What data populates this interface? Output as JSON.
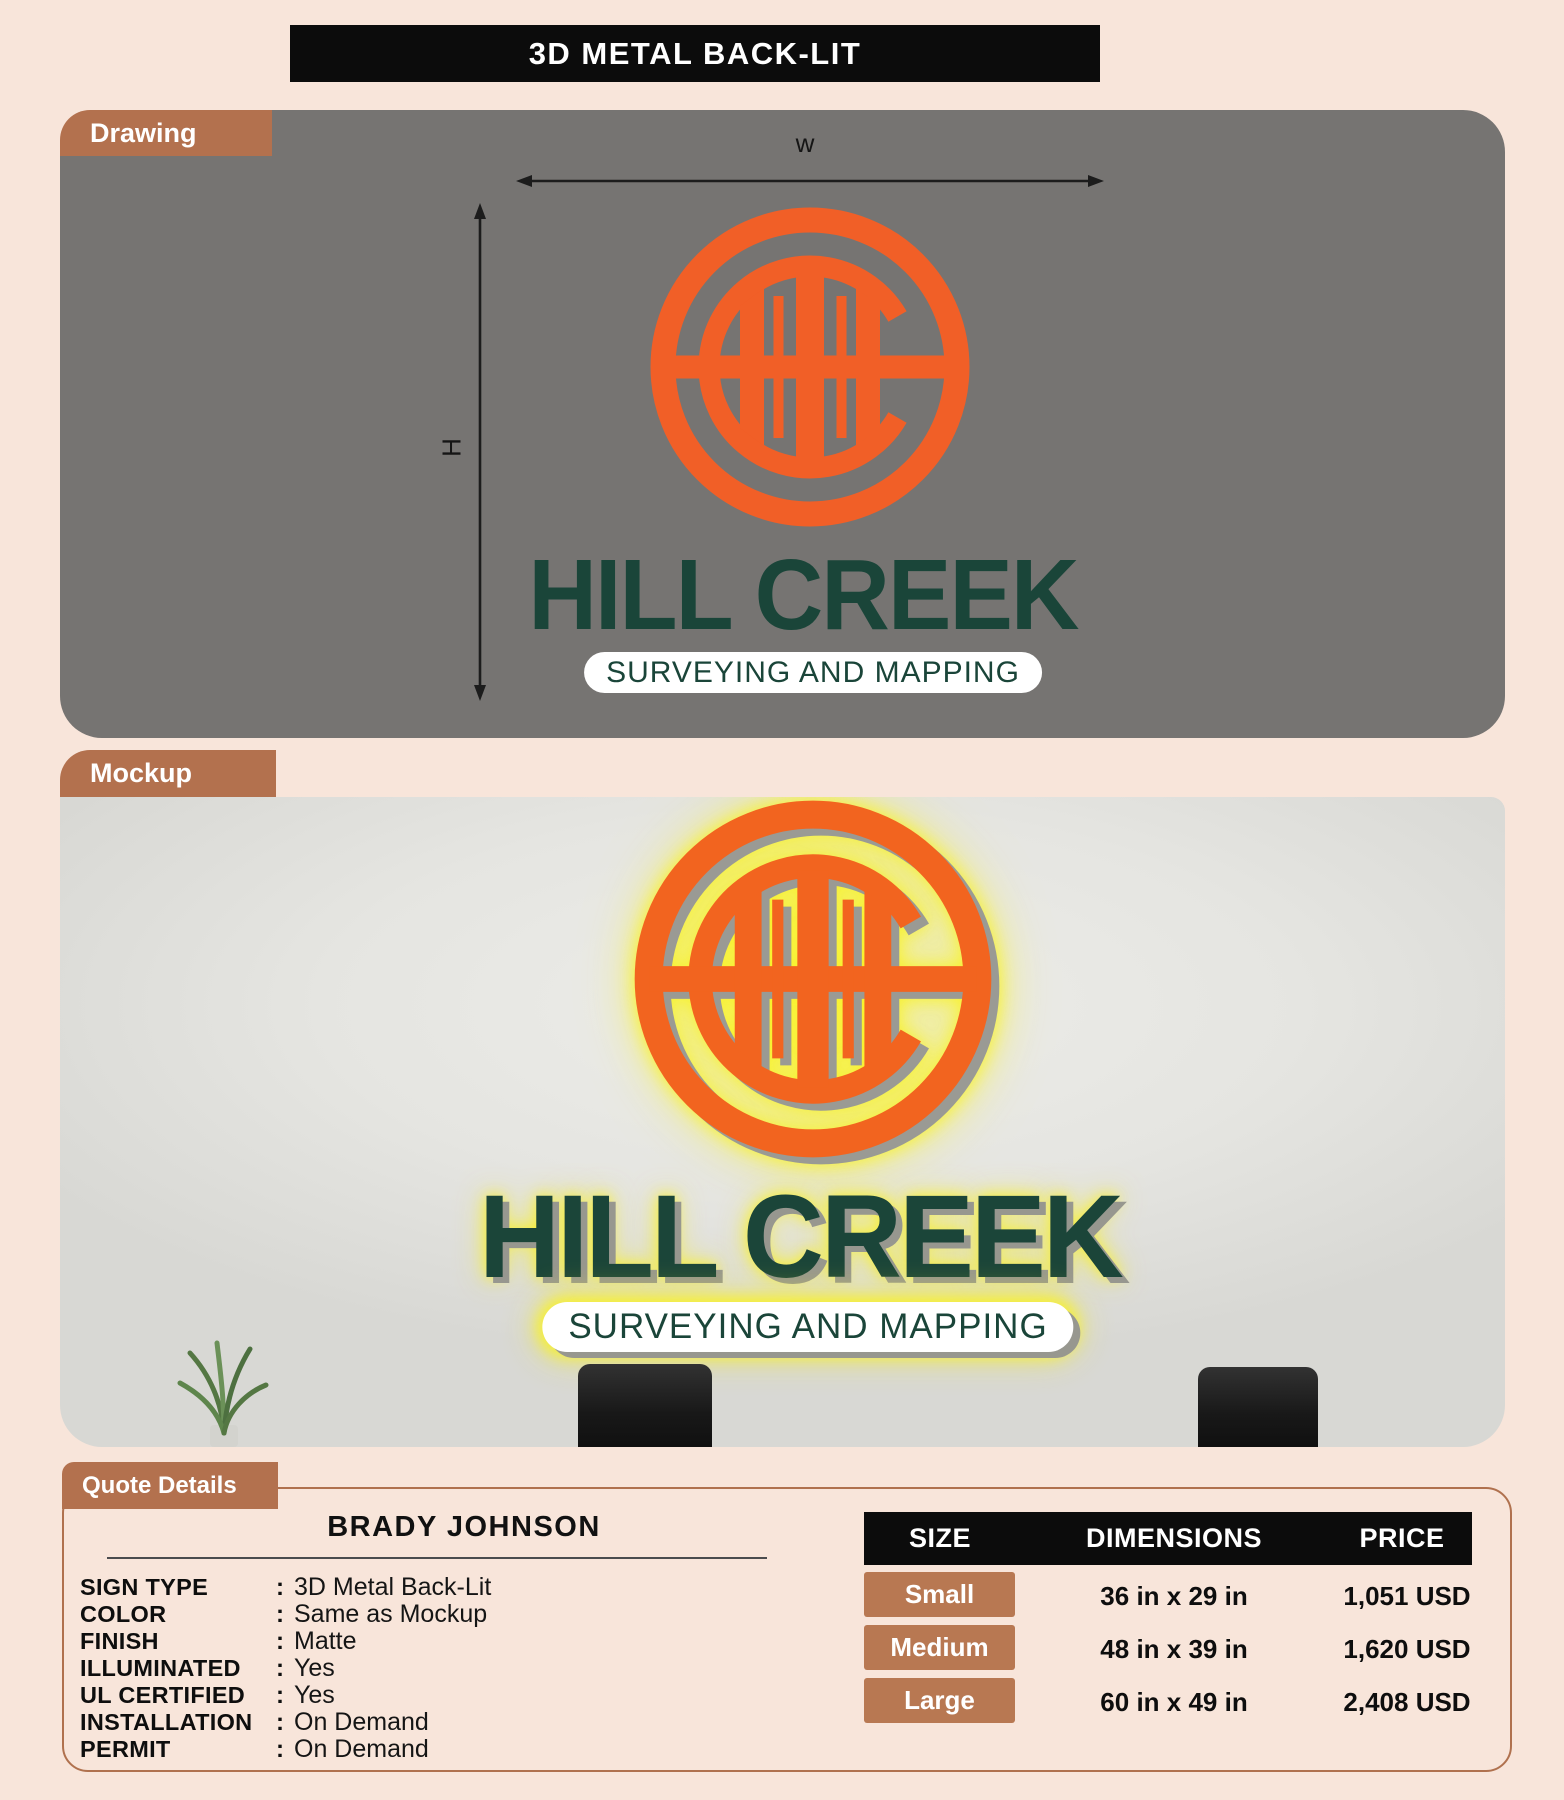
{
  "title": "3D METAL BACK-LIT",
  "drawing": {
    "tab_label": "Drawing",
    "width_label": "w",
    "height_label": "H",
    "brand": "HILL CREEK",
    "tagline": "SURVEYING AND MAPPING"
  },
  "mockup": {
    "tab_label": "Mockup",
    "brand": "HILL CREEK",
    "tagline": "SURVEYING AND MAPPING"
  },
  "quote": {
    "tab_label": "Quote Details",
    "customer_name": "BRADY JOHNSON",
    "colon": ":",
    "specs": [
      {
        "label": "SIGN TYPE",
        "value": "3D Metal Back-Lit"
      },
      {
        "label": "COLOR",
        "value": "Same as Mockup"
      },
      {
        "label": "FINISH",
        "value": "Matte"
      },
      {
        "label": "ILLUMINATED",
        "value": "Yes"
      },
      {
        "label": "UL CERTIFIED",
        "value": "Yes"
      },
      {
        "label": "INSTALLATION",
        "value": "On Demand"
      },
      {
        "label": "PERMIT",
        "value": "On Demand"
      }
    ],
    "table": {
      "headers": [
        "SIZE",
        "DIMENSIONS",
        "PRICE"
      ],
      "rows": [
        {
          "size": "Small",
          "dimensions": "36 in x 29 in",
          "price": "1,051 USD"
        },
        {
          "size": "Medium",
          "dimensions": "48 in x 39 in",
          "price": "1,620 USD"
        },
        {
          "size": "Large",
          "dimensions": "60 in x 49 in",
          "price": "2,408 USD"
        }
      ]
    }
  },
  "colors": {
    "page_bg": "#f8e5da",
    "panel_gray": "#767472",
    "tab_brown": "#b3714e",
    "button_brown": "#b87852",
    "logo_orange": "#f15f27",
    "brand_green": "#1a4539",
    "glow_yellow": "#f8ef25",
    "shadow_3d_gray": "#9a9a94",
    "table_header_bg": "#0c0c0c",
    "wall_gray": "#e6e6e3"
  }
}
